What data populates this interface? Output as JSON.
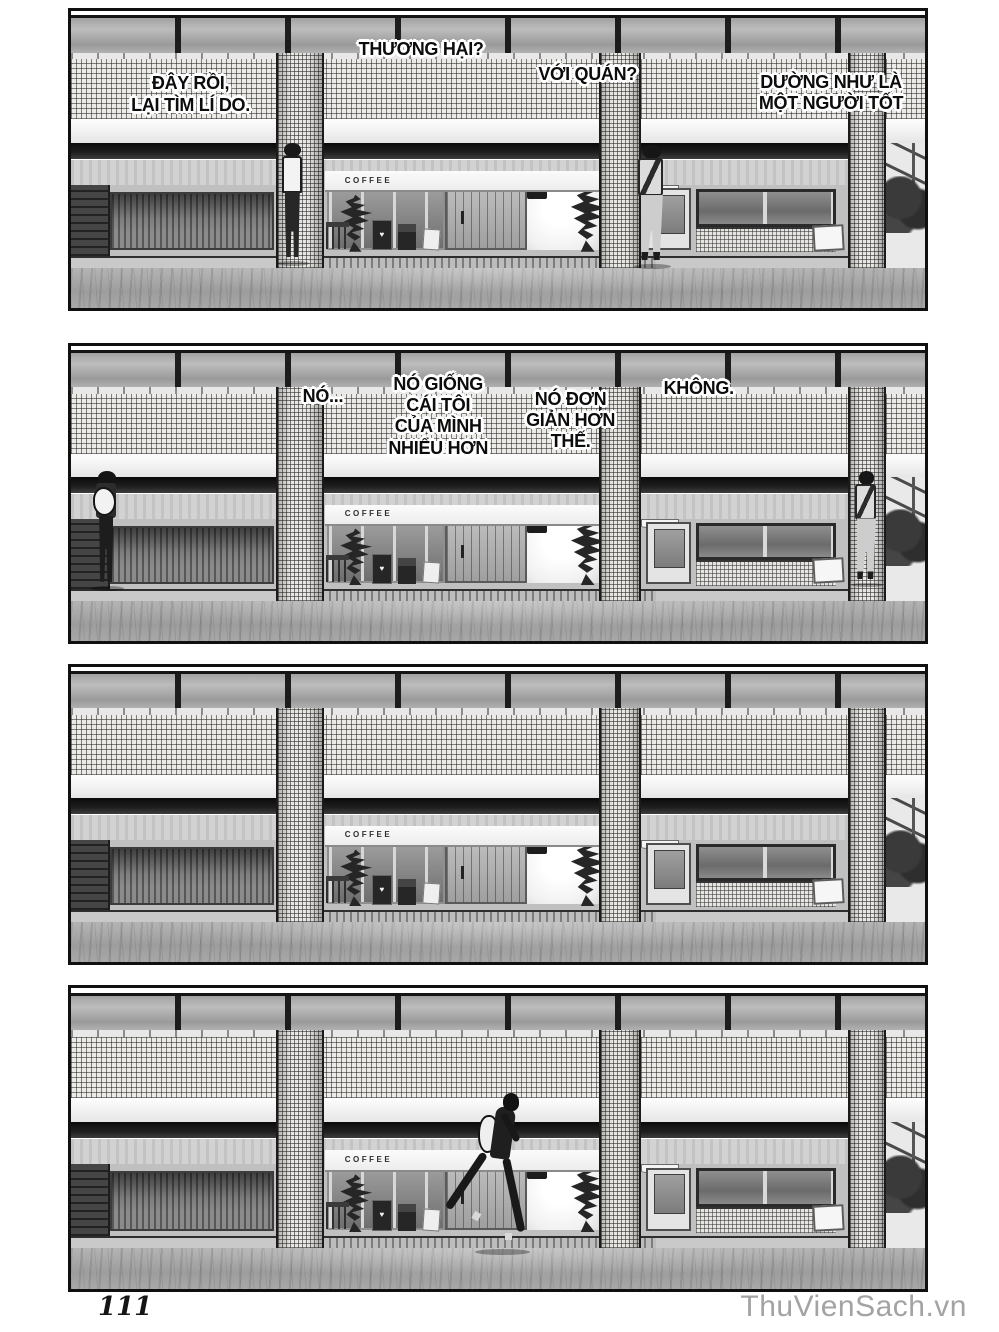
{
  "page": {
    "number": "111",
    "watermark": "ThuVienSach.vn"
  },
  "scene": {
    "coffee_sign": "COFFEE",
    "heart_glyph": "♥"
  },
  "panels": [
    {
      "name": "panel-1",
      "bubbles": [
        {
          "text": "ĐÂY RỒI,\nLẠI TÌM LÍ DO."
        },
        {
          "text": "THƯƠNG HẠI?"
        },
        {
          "text": "VỚI QUÁN?"
        },
        {
          "text": "DƯỜNG NHƯ LÀ\nMỘT NGƯỜI TỐT"
        }
      ]
    },
    {
      "name": "panel-2",
      "bubbles": [
        {
          "text": "NÓ..."
        },
        {
          "text": "NÓ GIỐNG\nCÁI TÔI\nCỦA MÌNH\nNHIỂU HƠN"
        },
        {
          "text": "NÓ ĐƠN\nGIẢN HƠN\nTHẾ."
        },
        {
          "text": "KHÔNG."
        }
      ]
    },
    {
      "name": "panel-3",
      "bubbles": []
    },
    {
      "name": "panel-4",
      "bubbles": []
    }
  ]
}
